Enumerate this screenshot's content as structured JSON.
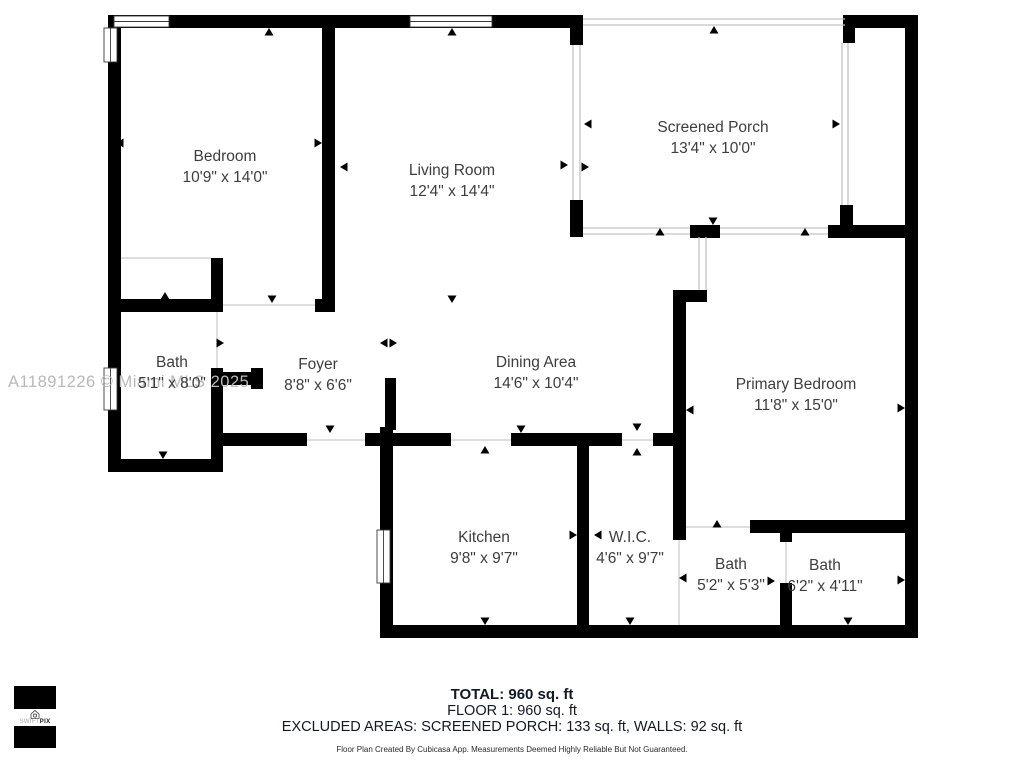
{
  "floor_plan": {
    "rooms": [
      {
        "label": "Bedroom",
        "dims": "10'9\" x 14'0\""
      },
      {
        "label": "Living Room",
        "dims": "12'4\" x 14'4\""
      },
      {
        "label": "Screened Porch",
        "dims": "13'4\" x 10'0\""
      },
      {
        "label": "Bath",
        "dims": "5'1\" x 8'0\""
      },
      {
        "label": "Foyer",
        "dims": "8'8\" x 6'6\""
      },
      {
        "label": "Dining Area",
        "dims": "14'6\" x 10'4\""
      },
      {
        "label": "Primary Bedroom",
        "dims": "11'8\" x 15'0\""
      },
      {
        "label": "Kitchen",
        "dims": "9'8\" x 9'7\""
      },
      {
        "label": "W.I.C.",
        "dims": "4'6\" x 9'7\""
      },
      {
        "label": "Bath",
        "dims": "5'2\" x 5'3\""
      },
      {
        "label": "Bath",
        "dims": "6'2\" x 4'11\""
      }
    ],
    "watermark": "A11891226 © Miami MLS 2025",
    "footer": {
      "total": "TOTAL: 960 sq. ft",
      "floor": "FLOOR 1: 960 sq. ft",
      "excluded": "EXCLUDED AREAS: SCREENED PORCH: 133 sq. ft, WALLS: 92 sq. ft",
      "disclaimer": "Floor Plan Created By Cubicasa App. Measurements Deemed Highly Reliable But Not Guaranteed."
    },
    "logo": {
      "brand_light": "SWIFT",
      "brand_bold": "PIX"
    },
    "colors": {
      "wall": "#000000",
      "screen_line": "#c4c4c4",
      "room_text": "#3d3d3d",
      "footer_text": "#121a26",
      "watermark": "#b9b9b9"
    }
  }
}
